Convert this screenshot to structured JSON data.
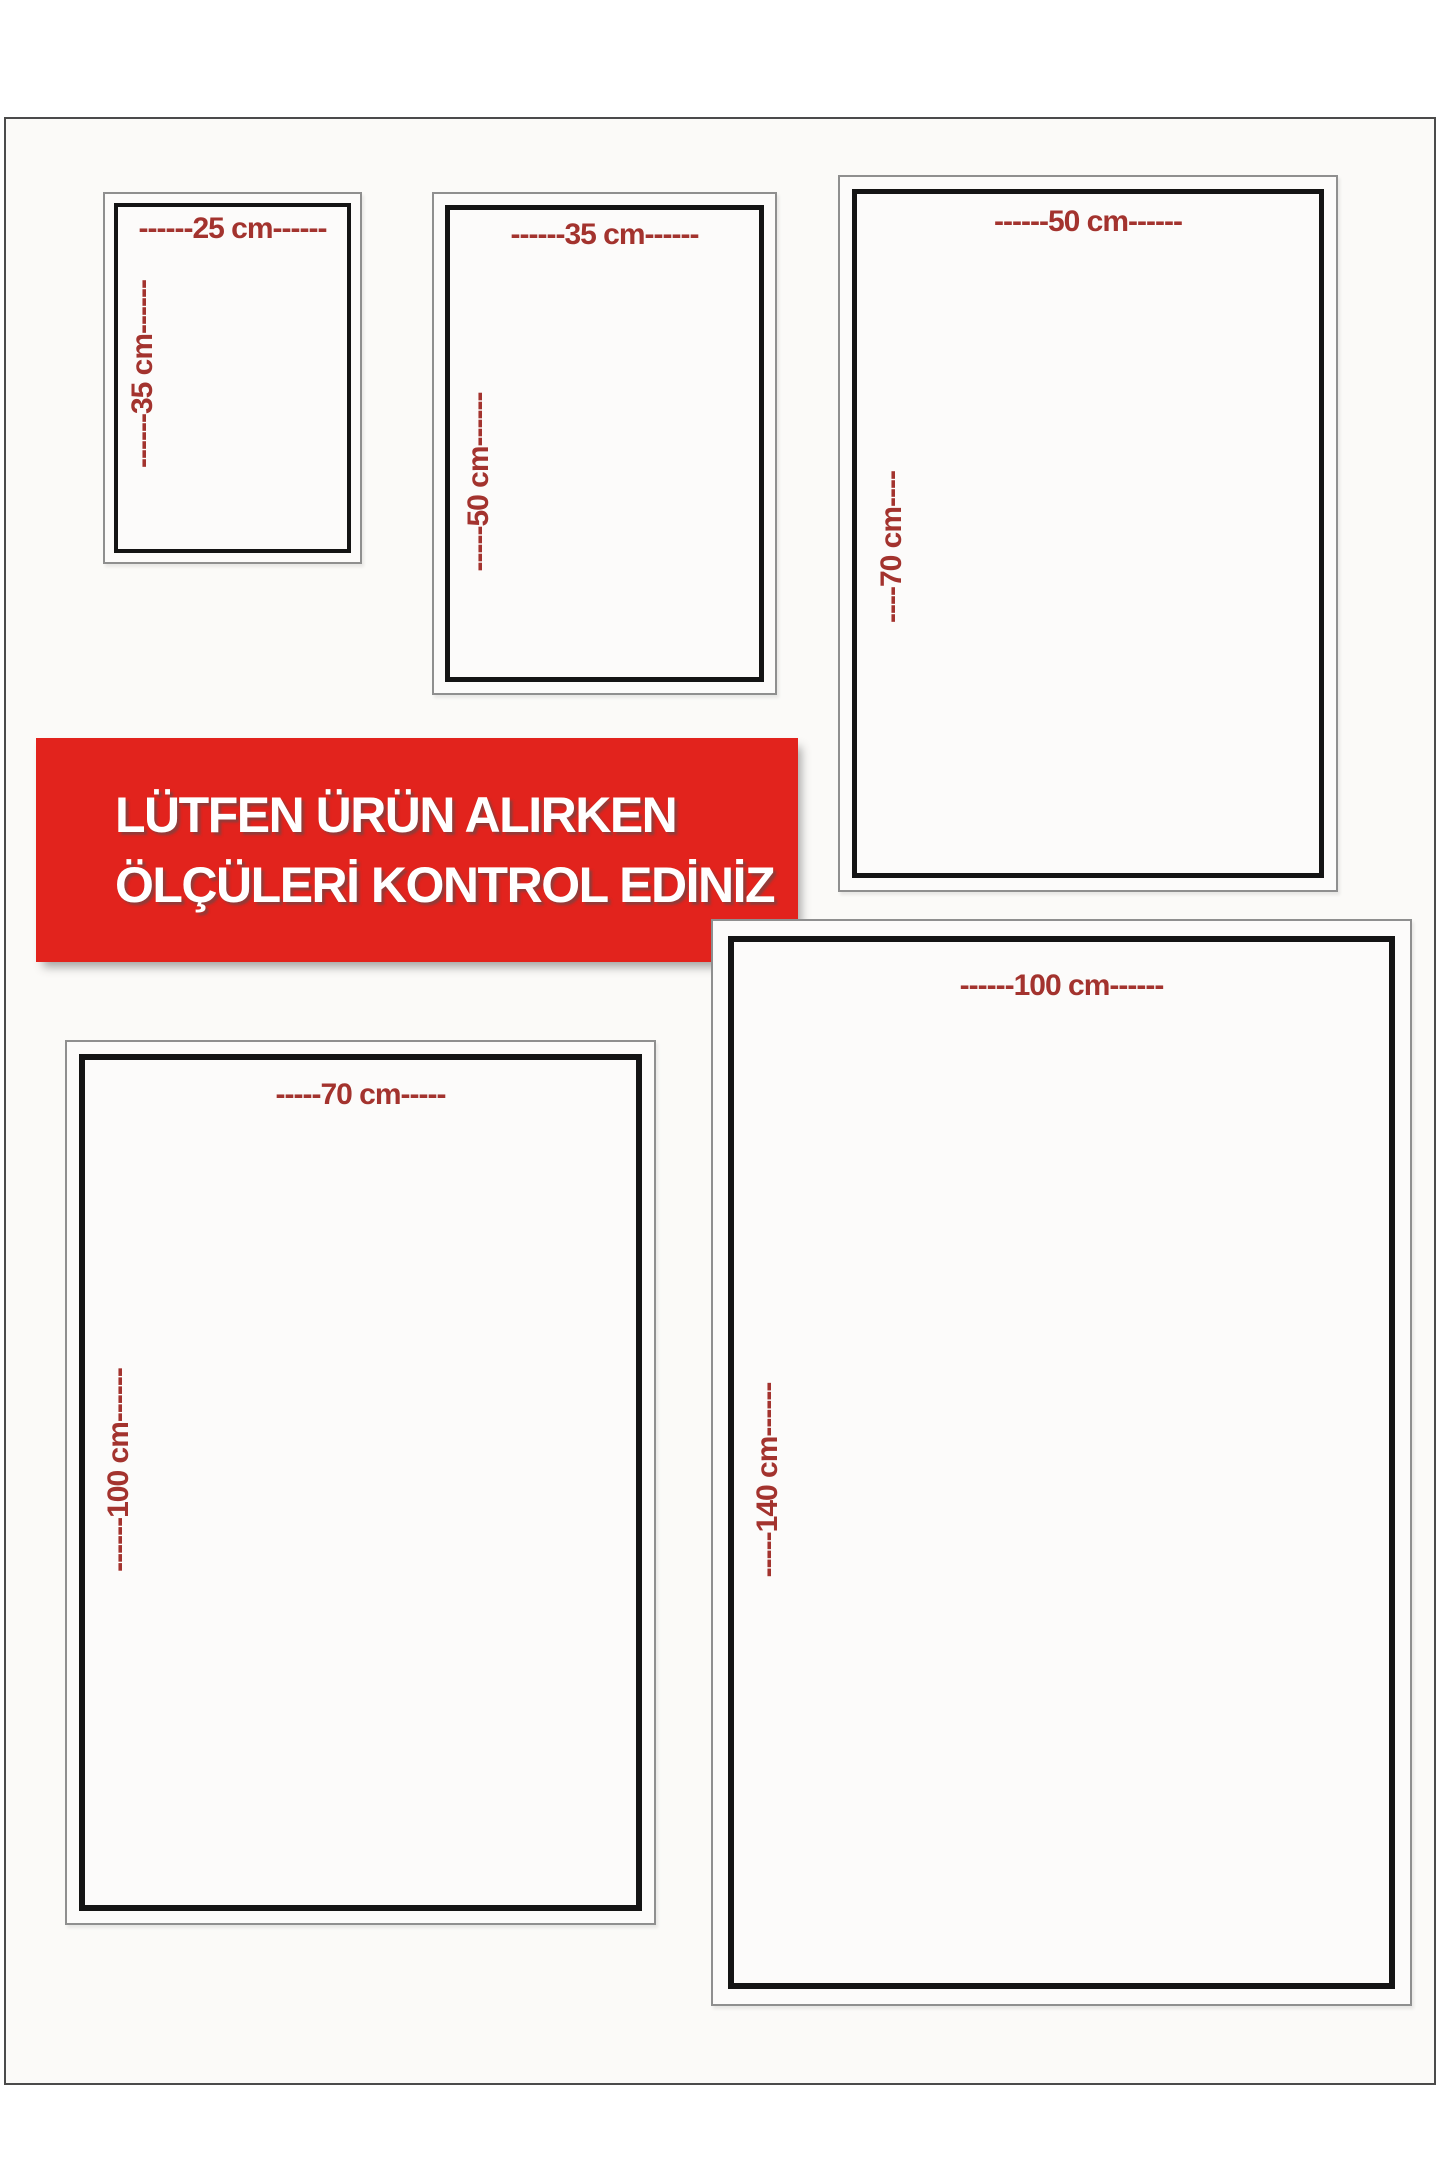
{
  "banner": {
    "line1": "LÜTFEN ÜRÜN ALIRKEN",
    "line2": "ÖLÇÜLERİ KONTROL EDİNİZ"
  },
  "boxes": [
    {
      "id": "25x35",
      "width_label": "------25 cm------",
      "height_label": "------35 cm------"
    },
    {
      "id": "35x50",
      "width_label": "------35 cm------",
      "height_label": "-----50 cm------"
    },
    {
      "id": "50x70",
      "width_label": "------50 cm------",
      "height_label": "----70 cm----"
    },
    {
      "id": "70x100",
      "width_label": "-----70 cm-----",
      "height_label": "------100 cm------"
    },
    {
      "id": "100x140",
      "width_label": "------100 cm------",
      "height_label": "-----140 cm------"
    }
  ],
  "colors": {
    "label_red": "#a3332e",
    "banner_red": "#e2231d",
    "banner_text": "#ffffff",
    "border_black": "#141414",
    "border_gray": "#8f8f8f",
    "page_background": "#fbfaf8"
  }
}
